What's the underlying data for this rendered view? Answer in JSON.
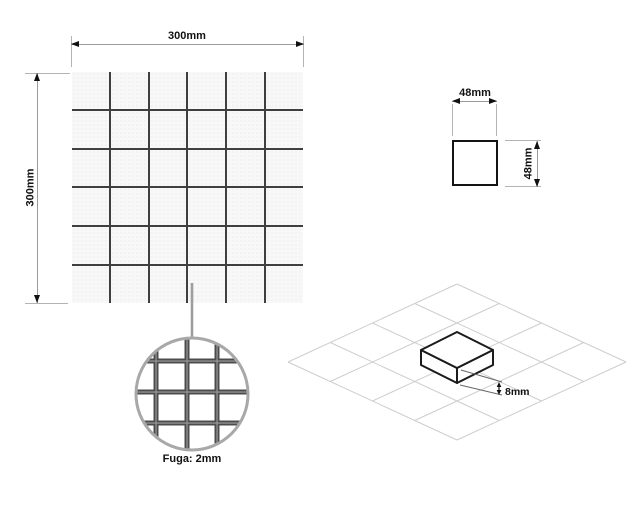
{
  "page": {
    "background": "#ffffff"
  },
  "mosaic_panel": {
    "description": "mosaic sheet top view",
    "rows": 6,
    "cols": 6,
    "width_label": "300mm",
    "height_label": "300mm",
    "tile_color": "#f8f8f8",
    "grout_color": "#3f3f3f"
  },
  "chip_panel": {
    "description": "single chip top view",
    "width_label": "48mm",
    "height_label": "48mm",
    "chip_color": "#ffffff",
    "border_color": "#141414"
  },
  "magnifier_panel": {
    "label": "Fuga: 2mm",
    "circle_color": "#a8a8a8",
    "grout_color": "#4c4c4c",
    "grout_center_color": "#949494"
  },
  "iso_panel": {
    "description": "isometric view of single tile on layout grid",
    "thickness_label": "8mm",
    "grid_rows": 4,
    "grid_cols": 4,
    "grid_line_color": "#cdcdcd",
    "tile_edge_color": "#1b1b1b"
  },
  "dimension_style": {
    "line_color": "#9a9a9a",
    "extension_color": "#b4b4b4",
    "arrow_color": "#111111",
    "text_color": "#111111"
  }
}
